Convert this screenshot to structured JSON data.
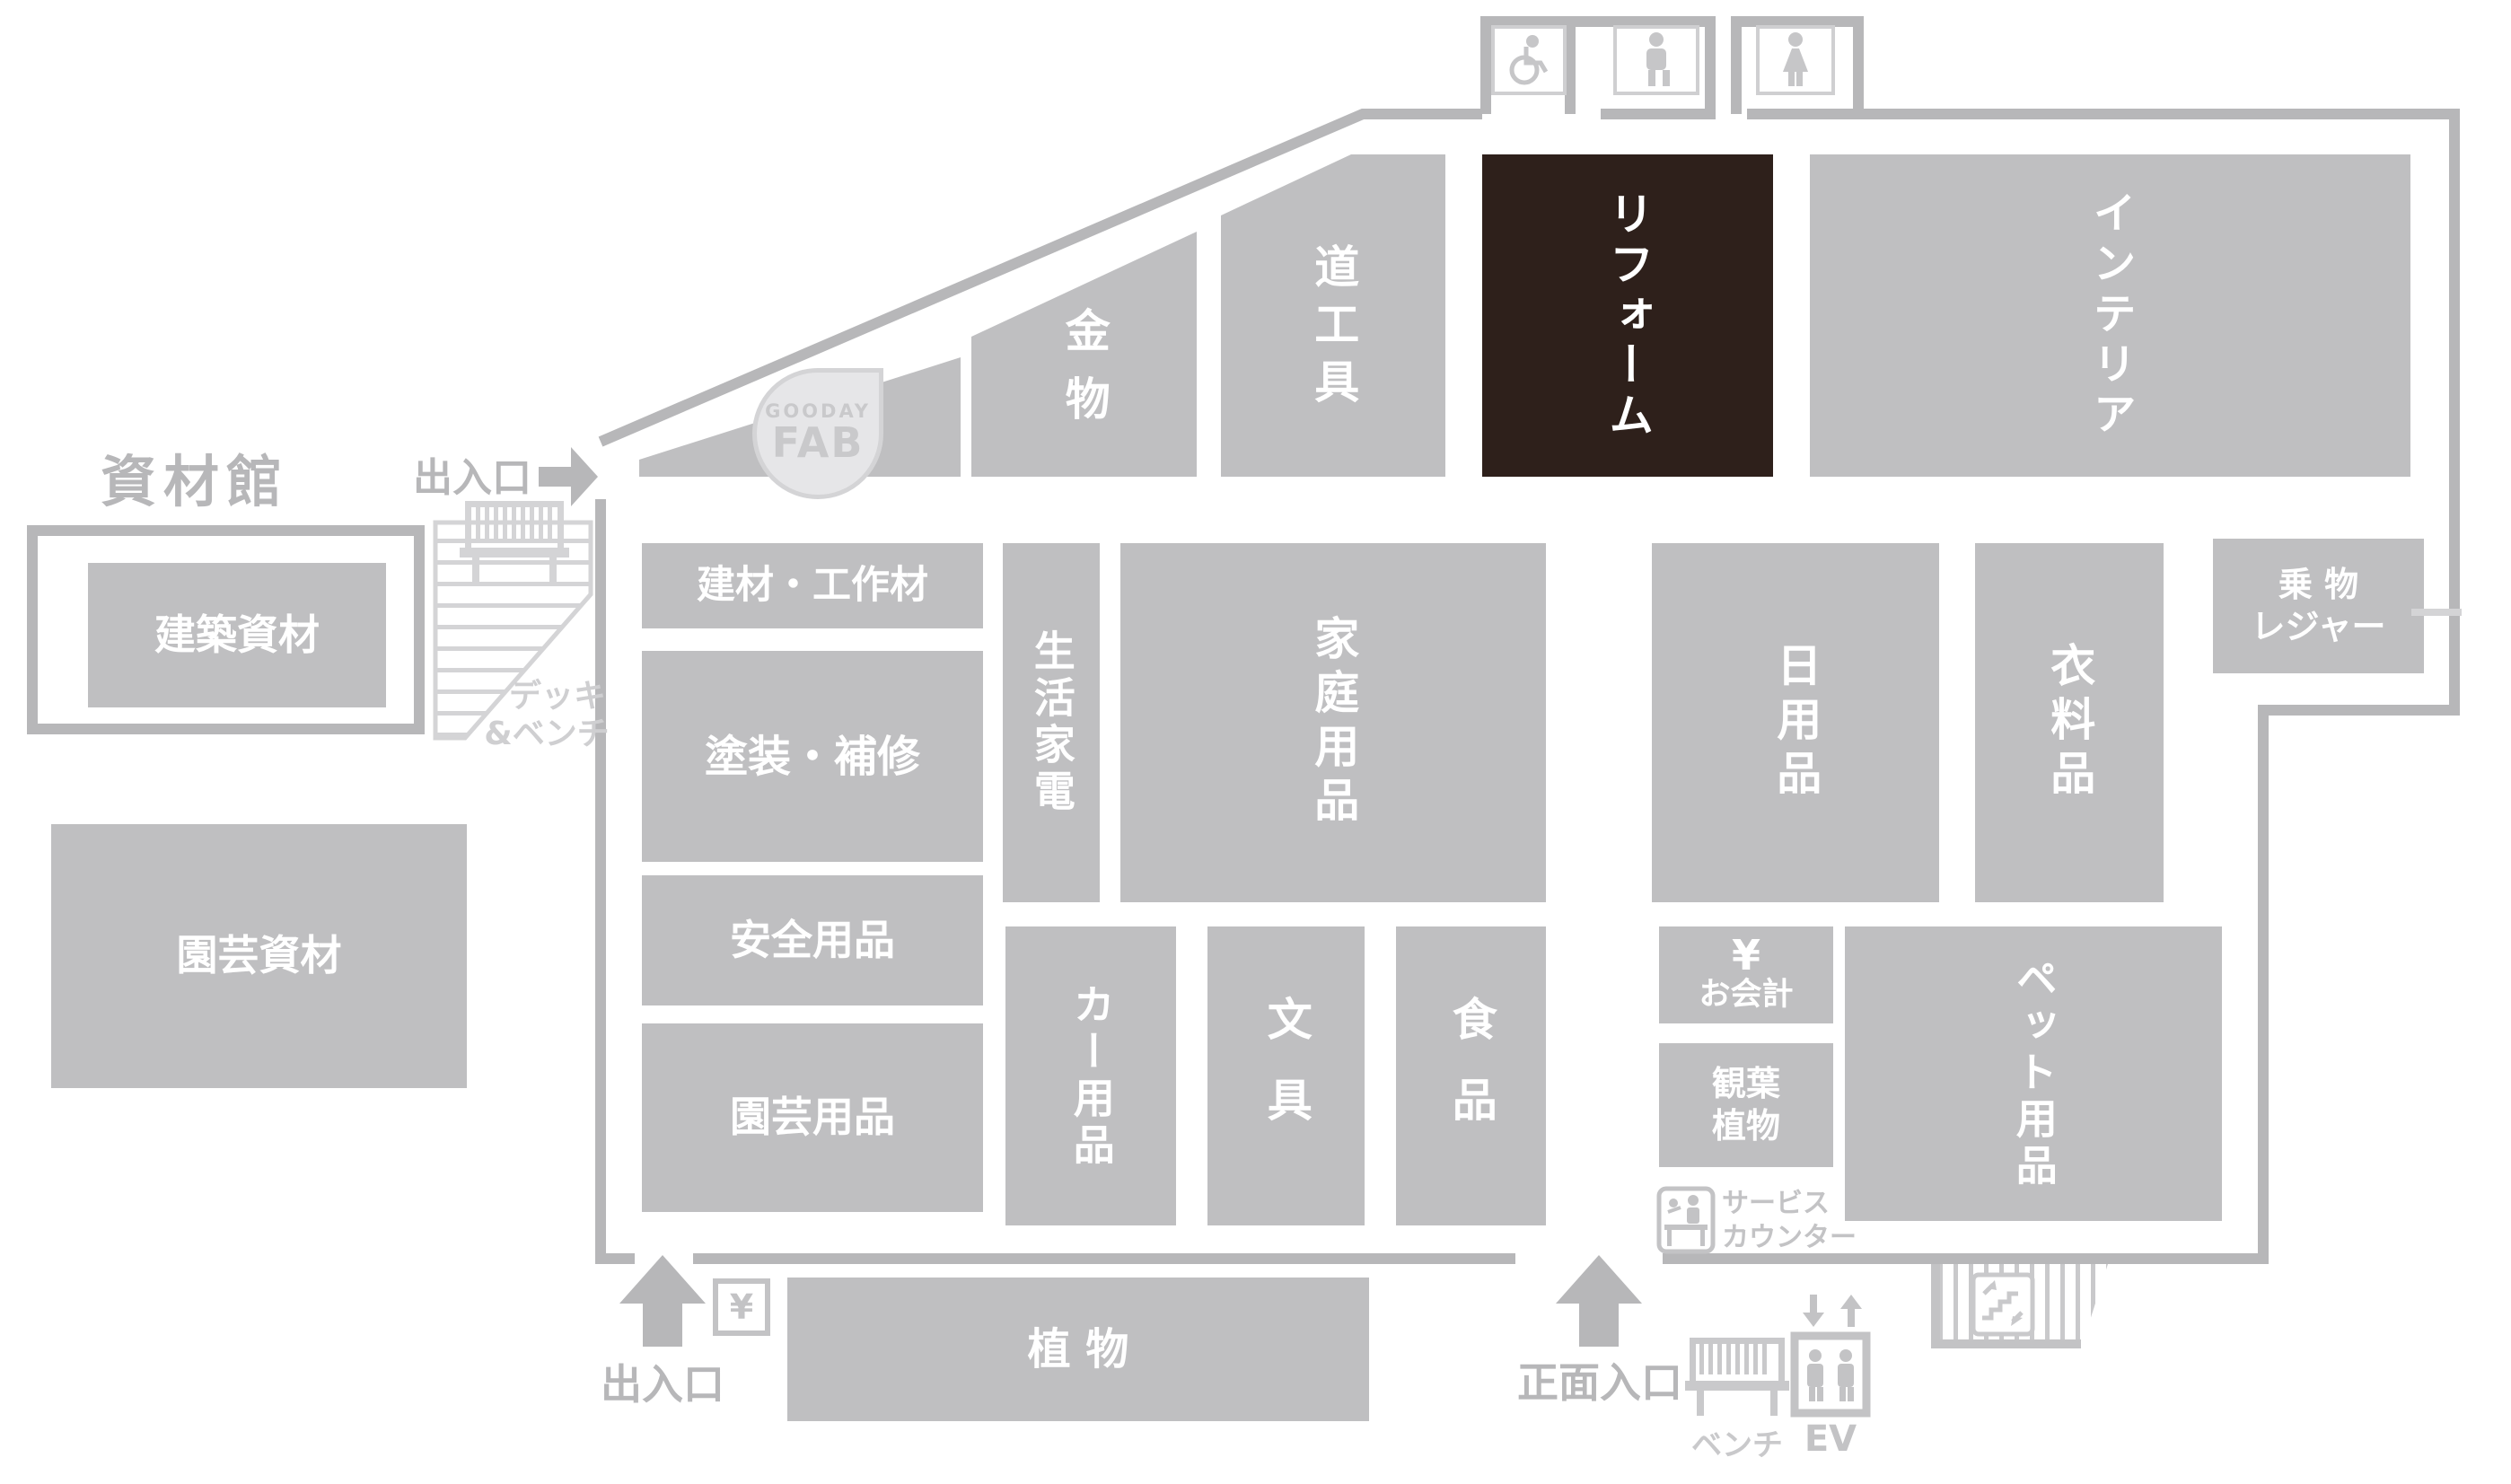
{
  "colors": {
    "block_gray": "#bfbfc1",
    "highlight_brown": "#2e201b",
    "wall_gray": "#b7b7b9",
    "light_gray": "#d4d4d6",
    "fab_badge_bg": "#e6e6e8",
    "text_on_block": "#ffffff"
  },
  "annex": {
    "title": "資材館",
    "building_materials": "建築資材",
    "garden_materials": "園芸資材",
    "deck_line1": "デッキ",
    "deck_line2": "&ベンチ"
  },
  "entrances": {
    "side": "出入口",
    "left": "出入口",
    "main": "正面入口"
  },
  "fab": {
    "line1": "GOODAY",
    "line2": "FAB"
  },
  "blocks": {
    "kanamono": "金物",
    "dougu": "道工具",
    "reform": "リフォーム",
    "interior": "インテリア",
    "kenzai": "建材・工作材",
    "tosou": "塗装・補修",
    "anzen": "安全用品",
    "engei": "園芸用品",
    "seikatsu": "生活家電",
    "katei": "家庭用品",
    "car": "カー用品",
    "bungu": "文具",
    "shokuhin": "食品",
    "nichiyo": "日用品",
    "iryo": "衣料品",
    "norimono_line1": "乗 物",
    "norimono_line2": "レジャー",
    "pet": "ペット用品",
    "kanyou_line1": "観葉",
    "kanyou_line2": "植物",
    "shokubutsu": "植 物"
  },
  "facilities": {
    "yen": "¥",
    "checkout": "お会計",
    "service_line1": "サービス",
    "service_line2": "カウンター",
    "bench": "ベンチ",
    "ev": "EV"
  }
}
